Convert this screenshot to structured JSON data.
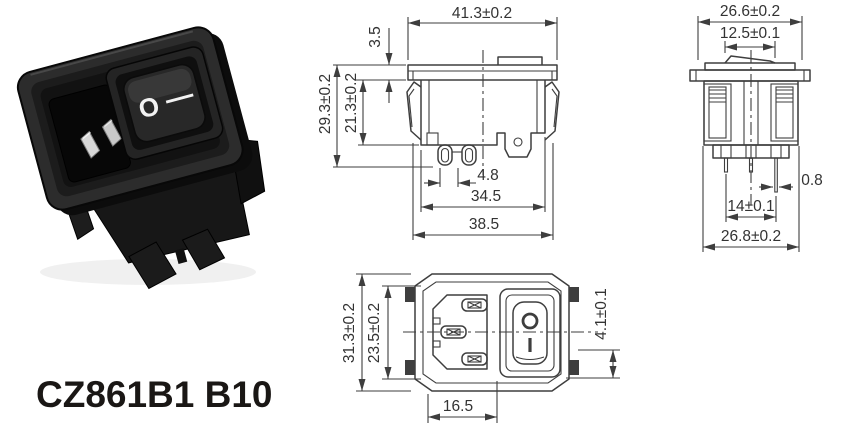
{
  "model_label": "CZ861B1 B10",
  "colors": {
    "line": "#3e3e3e",
    "dim_text": "#333333",
    "label_text": "#1a1715",
    "background": "#ffffff",
    "photo_body": "#2c2c2c",
    "photo_recess": "#121212",
    "photo_pin_metal": "#d8d8d8",
    "photo_marking": "#f2f2f2"
  },
  "photo": {
    "rocker_off_marking": "O",
    "rocker_on_marking": "—"
  },
  "front_view": {
    "dims": {
      "flange_width": "41.3±0.2",
      "flange_thickness": "3.5",
      "overall_height": "29.3±0.2",
      "body_height": "21.3±0.2",
      "pin_pitch": "4.8",
      "body_width": "34.5",
      "clip_span": "38.5"
    }
  },
  "side_view": {
    "dims": {
      "flange_width": "26.6±0.2",
      "rocker_width": "12.5±0.1",
      "pin_thickness": "0.8",
      "pin_pitch": "14±0.1",
      "body_width": "26.8±0.2"
    }
  },
  "face_view": {
    "dims": {
      "overall_height": "31.3±0.2",
      "opening_height": "23.5±0.2",
      "rocker_clearance": "4.1±0.1",
      "inlet_width": "16.5"
    },
    "rocker_symbols": {
      "off": "O",
      "on": "I"
    }
  }
}
